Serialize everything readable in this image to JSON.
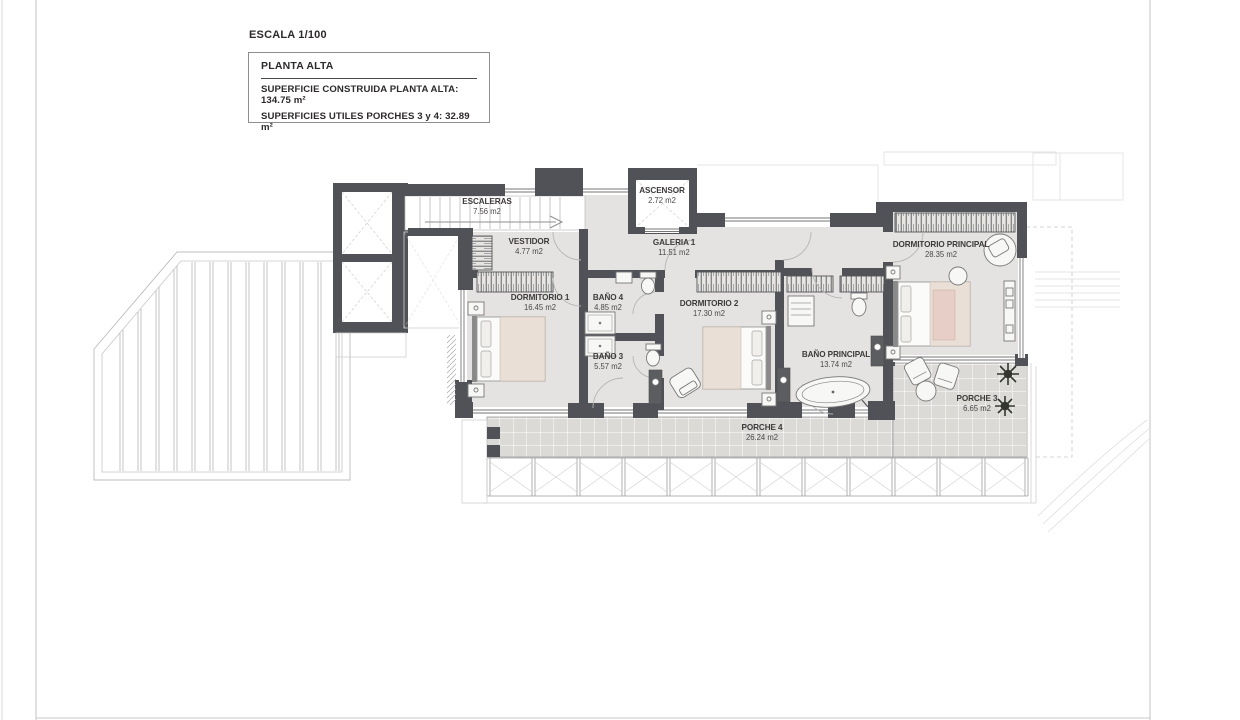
{
  "sheet": {
    "scale_label": "ESCALA 1/100",
    "title_box": {
      "title": "PLANTA ALTA",
      "area_line_1": "SUPERFICIE CONSTRUIDA PLANTA ALTA: 134.75 m²",
      "area_line_2": "SUPERFICIES UTILES PORCHES 3 y 4: 32.89 m²"
    }
  },
  "rooms": [
    {
      "name": "ESCALERAS",
      "area": "7.56 m2"
    },
    {
      "name": "ASCENSOR",
      "area": "2.72 m2"
    },
    {
      "name": "VESTIDOR",
      "area": "4.77 m2"
    },
    {
      "name": "GALERIA 1",
      "area": "11.51 m2"
    },
    {
      "name": "DORMITORIO PRINCIPAL",
      "area": "28.35 m2"
    },
    {
      "name": "DORMITORIO 1",
      "area": "16.45 m2"
    },
    {
      "name": "BAÑO 4",
      "area": "4.85 m2"
    },
    {
      "name": "DORMITORIO 2",
      "area": "17.30 m2"
    },
    {
      "name": "BAÑO 3",
      "area": "5.57 m2"
    },
    {
      "name": "BAÑO PRINCIPAL",
      "area": "13.74 m2"
    },
    {
      "name": "PORCHE 3",
      "area": "6.65 m2"
    },
    {
      "name": "PORCHE 4",
      "area": "26.24 m2"
    }
  ],
  "colors": {
    "wall": "#515257",
    "floor": "#e4e3e1",
    "porch_tile": "#dbdad7",
    "label_text": "#3e3a3b",
    "light_line": "#bcbcbc"
  }
}
